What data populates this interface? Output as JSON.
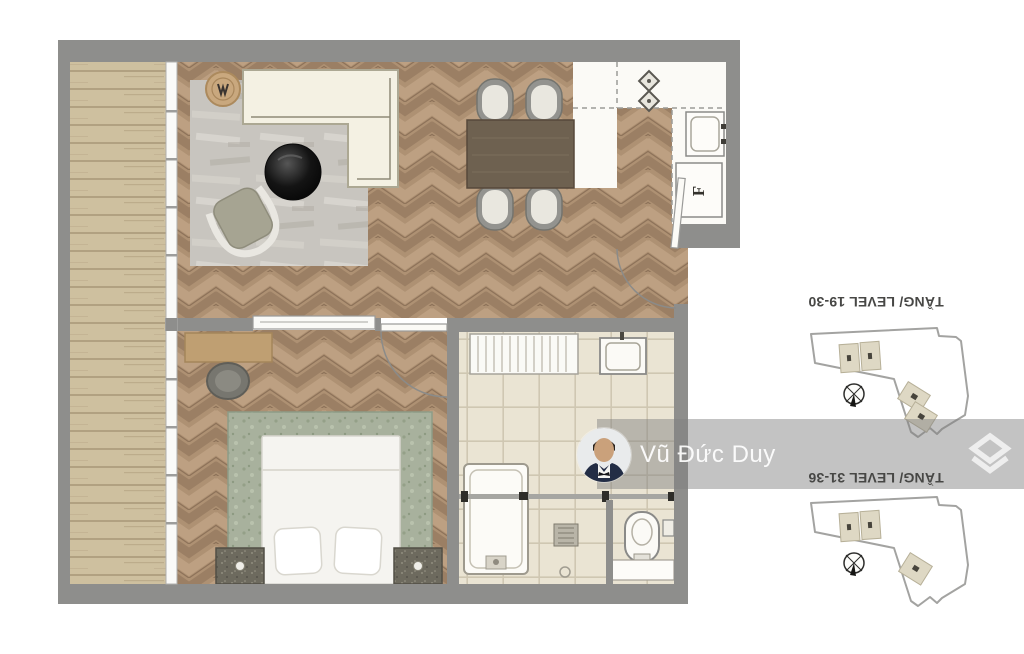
{
  "watermark": {
    "name": "Vũ Đức Duy",
    "band_color": "#c3c3c3",
    "text_color": "#ffffff"
  },
  "key_plans": [
    {
      "label": "TẦNG/ LEVEL 19-30"
    },
    {
      "label": "TẦNG/ LEVEL 31-36"
    }
  ],
  "floor_plan": {
    "fridge_label": "F"
  },
  "colors": {
    "wall": "#8e8e8c",
    "wood_floor": "#ae9173",
    "balcony_wood": "#cec09f",
    "bathroom_tile": "#eae4d3",
    "bed_frame": "#a8b19d"
  }
}
